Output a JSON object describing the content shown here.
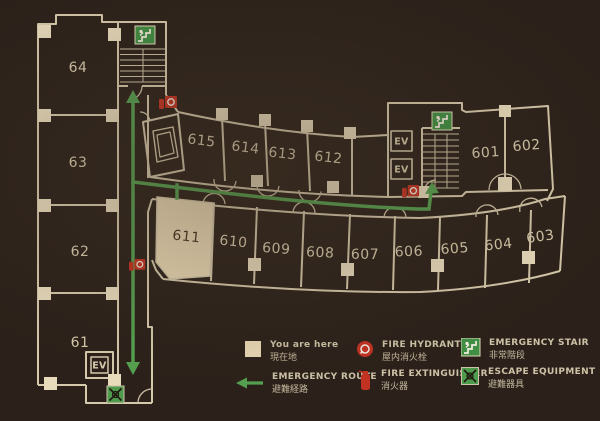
{
  "plan": {
    "you_are_here_room": "611",
    "elevator_label": "EV",
    "rooms": {
      "left_wing": [
        "64",
        "63",
        "62",
        "61"
      ],
      "top_row": [
        "615",
        "614",
        "613",
        "612"
      ],
      "right_rooms": [
        "601",
        "602"
      ],
      "bottom_row": [
        "611",
        "610",
        "609",
        "608",
        "607",
        "606",
        "605",
        "604",
        "603"
      ]
    }
  },
  "legend": {
    "you_are_here": {
      "en": "You are here",
      "ja": "現在地"
    },
    "emergency_route": {
      "en": "EMERGENCY ROUTE",
      "ja": "避難経路"
    },
    "fire_hydrant": {
      "en": "FIRE HYDRANT",
      "ja": "屋内消火栓"
    },
    "fire_extinguisher": {
      "en": "FIRE EXTINGUISHER",
      "ja": "消火器"
    },
    "emergency_stair": {
      "en": "EMERGENCY STAIR",
      "ja": "非常階段"
    },
    "escape_equipment": {
      "en": "ESCAPE EQUIPMENT",
      "ja": "避難器具"
    }
  },
  "colors": {
    "background": "#2b211a",
    "wall_line": "#d6c9ab",
    "room_highlight": "#ead9b5",
    "route_green": "#55a050",
    "equipment_red": "#c23222",
    "stair_green": "#3f8f44"
  }
}
